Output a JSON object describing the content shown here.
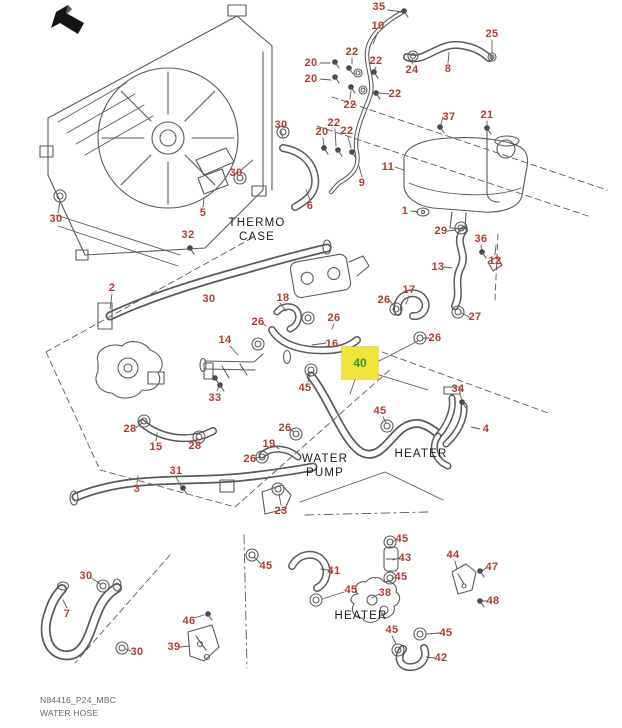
{
  "page": {
    "background": "#ffffff",
    "footer": {
      "line1": "N84416_P24_MBC",
      "line2": "WATER HOSE"
    }
  },
  "colors": {
    "part_label": "#b23c34",
    "line_art": "#5a5a5a",
    "component_text": "#1a1a1a",
    "highlight_bg": "#f0e63a",
    "highlight_text": "#3a9140",
    "direction_arrow": "#141414"
  },
  "icons": {
    "direction_arrow": "arrow-up-left-icon"
  },
  "diagram": {
    "highlighted_part": {
      "number": "40",
      "x": 360,
      "y": 362,
      "box_x": 342,
      "box_y": 347,
      "box_w": 36,
      "box_h": 32
    },
    "component_texts": [
      {
        "text": "THERMO\nCASE",
        "x": 257,
        "y": 231
      },
      {
        "text": "WATER\nPUMP",
        "x": 325,
        "y": 467
      },
      {
        "text": "HEATER",
        "x": 421,
        "y": 455
      },
      {
        "text": "HEATER",
        "x": 361,
        "y": 617
      }
    ],
    "part_labels": [
      {
        "n": "35",
        "x": 379,
        "y": 7
      },
      {
        "n": "10",
        "x": 378,
        "y": 26
      },
      {
        "n": "25",
        "x": 492,
        "y": 34
      },
      {
        "n": "22",
        "x": 352,
        "y": 52
      },
      {
        "n": "20",
        "x": 311,
        "y": 63
      },
      {
        "n": "22",
        "x": 376,
        "y": 61
      },
      {
        "n": "24",
        "x": 412,
        "y": 70
      },
      {
        "n": "8",
        "x": 448,
        "y": 69
      },
      {
        "n": "20",
        "x": 311,
        "y": 79
      },
      {
        "n": "22",
        "x": 395,
        "y": 94
      },
      {
        "n": "22",
        "x": 350,
        "y": 105
      },
      {
        "n": "37",
        "x": 449,
        "y": 117
      },
      {
        "n": "21",
        "x": 487,
        "y": 115
      },
      {
        "n": "22",
        "x": 334,
        "y": 123
      },
      {
        "n": "20",
        "x": 322,
        "y": 132
      },
      {
        "n": "22",
        "x": 347,
        "y": 131
      },
      {
        "n": "30",
        "x": 281,
        "y": 125
      },
      {
        "n": "30",
        "x": 236,
        "y": 173
      },
      {
        "n": "5",
        "x": 203,
        "y": 213
      },
      {
        "n": "6",
        "x": 310,
        "y": 206
      },
      {
        "n": "9",
        "x": 362,
        "y": 183
      },
      {
        "n": "11",
        "x": 388,
        "y": 167
      },
      {
        "n": "30",
        "x": 56,
        "y": 219
      },
      {
        "n": "1",
        "x": 405,
        "y": 211
      },
      {
        "n": "29",
        "x": 441,
        "y": 231
      },
      {
        "n": "36",
        "x": 481,
        "y": 239
      },
      {
        "n": "32",
        "x": 188,
        "y": 235
      },
      {
        "n": "13",
        "x": 438,
        "y": 267
      },
      {
        "n": "12",
        "x": 495,
        "y": 261
      },
      {
        "n": "2",
        "x": 112,
        "y": 288
      },
      {
        "n": "30",
        "x": 209,
        "y": 299
      },
      {
        "n": "18",
        "x": 283,
        "y": 298
      },
      {
        "n": "17",
        "x": 409,
        "y": 290
      },
      {
        "n": "26",
        "x": 384,
        "y": 300
      },
      {
        "n": "26",
        "x": 258,
        "y": 322
      },
      {
        "n": "26",
        "x": 334,
        "y": 318
      },
      {
        "n": "27",
        "x": 475,
        "y": 317
      },
      {
        "n": "16",
        "x": 332,
        "y": 344
      },
      {
        "n": "14",
        "x": 225,
        "y": 340
      },
      {
        "n": "26",
        "x": 435,
        "y": 338
      },
      {
        "n": "33",
        "x": 215,
        "y": 398
      },
      {
        "n": "45",
        "x": 305,
        "y": 388
      },
      {
        "n": "28",
        "x": 130,
        "y": 429
      },
      {
        "n": "15",
        "x": 156,
        "y": 447
      },
      {
        "n": "28",
        "x": 195,
        "y": 446
      },
      {
        "n": "26",
        "x": 285,
        "y": 428
      },
      {
        "n": "19",
        "x": 269,
        "y": 444
      },
      {
        "n": "26",
        "x": 250,
        "y": 459
      },
      {
        "n": "34",
        "x": 458,
        "y": 389
      },
      {
        "n": "45",
        "x": 380,
        "y": 411
      },
      {
        "n": "4",
        "x": 486,
        "y": 429
      },
      {
        "n": "31",
        "x": 176,
        "y": 471
      },
      {
        "n": "3",
        "x": 137,
        "y": 489
      },
      {
        "n": "23",
        "x": 281,
        "y": 511
      },
      {
        "n": "45",
        "x": 266,
        "y": 566
      },
      {
        "n": "30",
        "x": 86,
        "y": 576
      },
      {
        "n": "7",
        "x": 67,
        "y": 614
      },
      {
        "n": "30",
        "x": 137,
        "y": 652
      },
      {
        "n": "46",
        "x": 189,
        "y": 621
      },
      {
        "n": "39",
        "x": 174,
        "y": 647
      },
      {
        "n": "45",
        "x": 402,
        "y": 539
      },
      {
        "n": "43",
        "x": 405,
        "y": 558
      },
      {
        "n": "44",
        "x": 453,
        "y": 555
      },
      {
        "n": "47",
        "x": 492,
        "y": 567
      },
      {
        "n": "41",
        "x": 334,
        "y": 571
      },
      {
        "n": "45",
        "x": 351,
        "y": 590
      },
      {
        "n": "45",
        "x": 401,
        "y": 577
      },
      {
        "n": "38",
        "x": 385,
        "y": 593
      },
      {
        "n": "48",
        "x": 493,
        "y": 601
      },
      {
        "n": "45",
        "x": 392,
        "y": 630
      },
      {
        "n": "45",
        "x": 446,
        "y": 633
      },
      {
        "n": "42",
        "x": 441,
        "y": 658
      }
    ]
  }
}
